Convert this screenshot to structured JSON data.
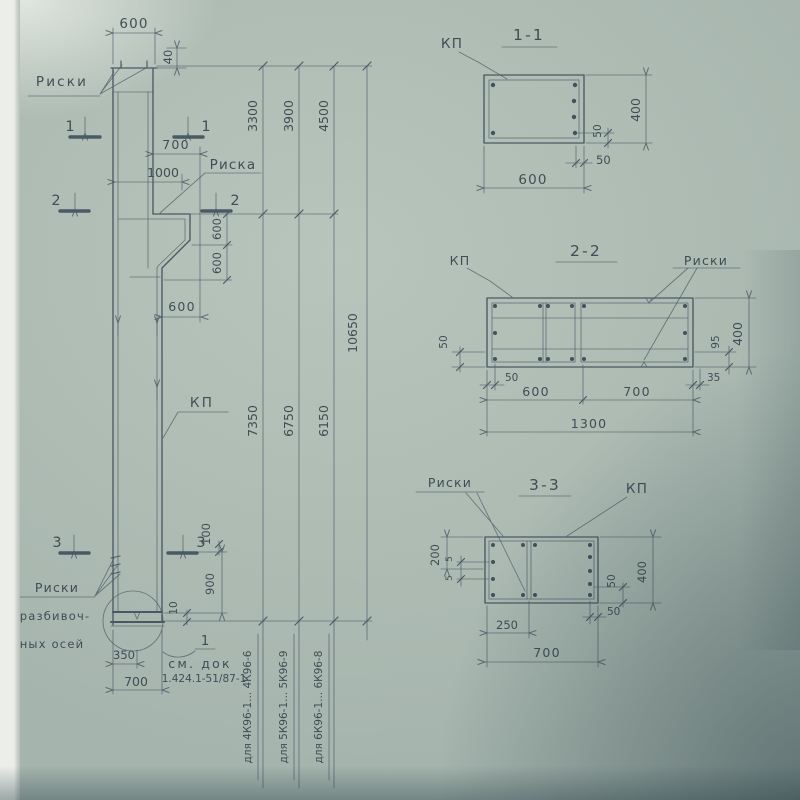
{
  "drawing": {
    "elevation": {
      "labels": {
        "riski_top": "Риски",
        "riska_mid": "Риска",
        "kp": "КП",
        "riski_axes_1": "Риски",
        "riski_axes_2": "разбивоч-",
        "riski_axes_3": "ных осей",
        "pos_1": "1",
        "see_doc_1": "см. док",
        "see_doc_2": "1.424.1-51/87-1"
      },
      "marks": {
        "s1": "1",
        "s2": "2",
        "s3": "3"
      },
      "dims": {
        "top_width": "600",
        "cap": "40",
        "d700": "700",
        "d1000": "1000",
        "corbel_1": "600",
        "corbel_2": "600",
        "corbel_3": "600",
        "d100": "100",
        "d900": "900",
        "d10": "10",
        "d350": "350",
        "bottom_700": "700"
      },
      "chains": {
        "c3300": "3300",
        "c3900": "3900",
        "c4500": "4500",
        "c7350": "7350",
        "c6750": "6750",
        "c6150": "6150",
        "total": "10650"
      },
      "applicability": [
        "для 4К96-1... 4К96-6",
        "для 5К96-1... 5К96-9",
        "для 6К96-1... 6К96-8"
      ]
    },
    "section_1_1": {
      "title": "1-1",
      "kp": "КП",
      "dims": {
        "width": "600",
        "height": "400",
        "off_v": "50",
        "off_h": "50"
      }
    },
    "section_2_2": {
      "title": "2-2",
      "kp": "КП",
      "riski": "Риски",
      "dims": {
        "left_50": "50",
        "bottom_50": "50",
        "d600": "600",
        "d700": "700",
        "total": "1300",
        "d35": "35",
        "d95": "95",
        "height": "400"
      }
    },
    "section_3_3": {
      "title": "3-3",
      "riski": "Риски",
      "kp": "КП",
      "dims": {
        "d200": "200",
        "d5a": "5",
        "d5b": "5",
        "d250": "250",
        "width": "700",
        "off_v": "50",
        "off_h": "50",
        "height": "400"
      }
    }
  }
}
